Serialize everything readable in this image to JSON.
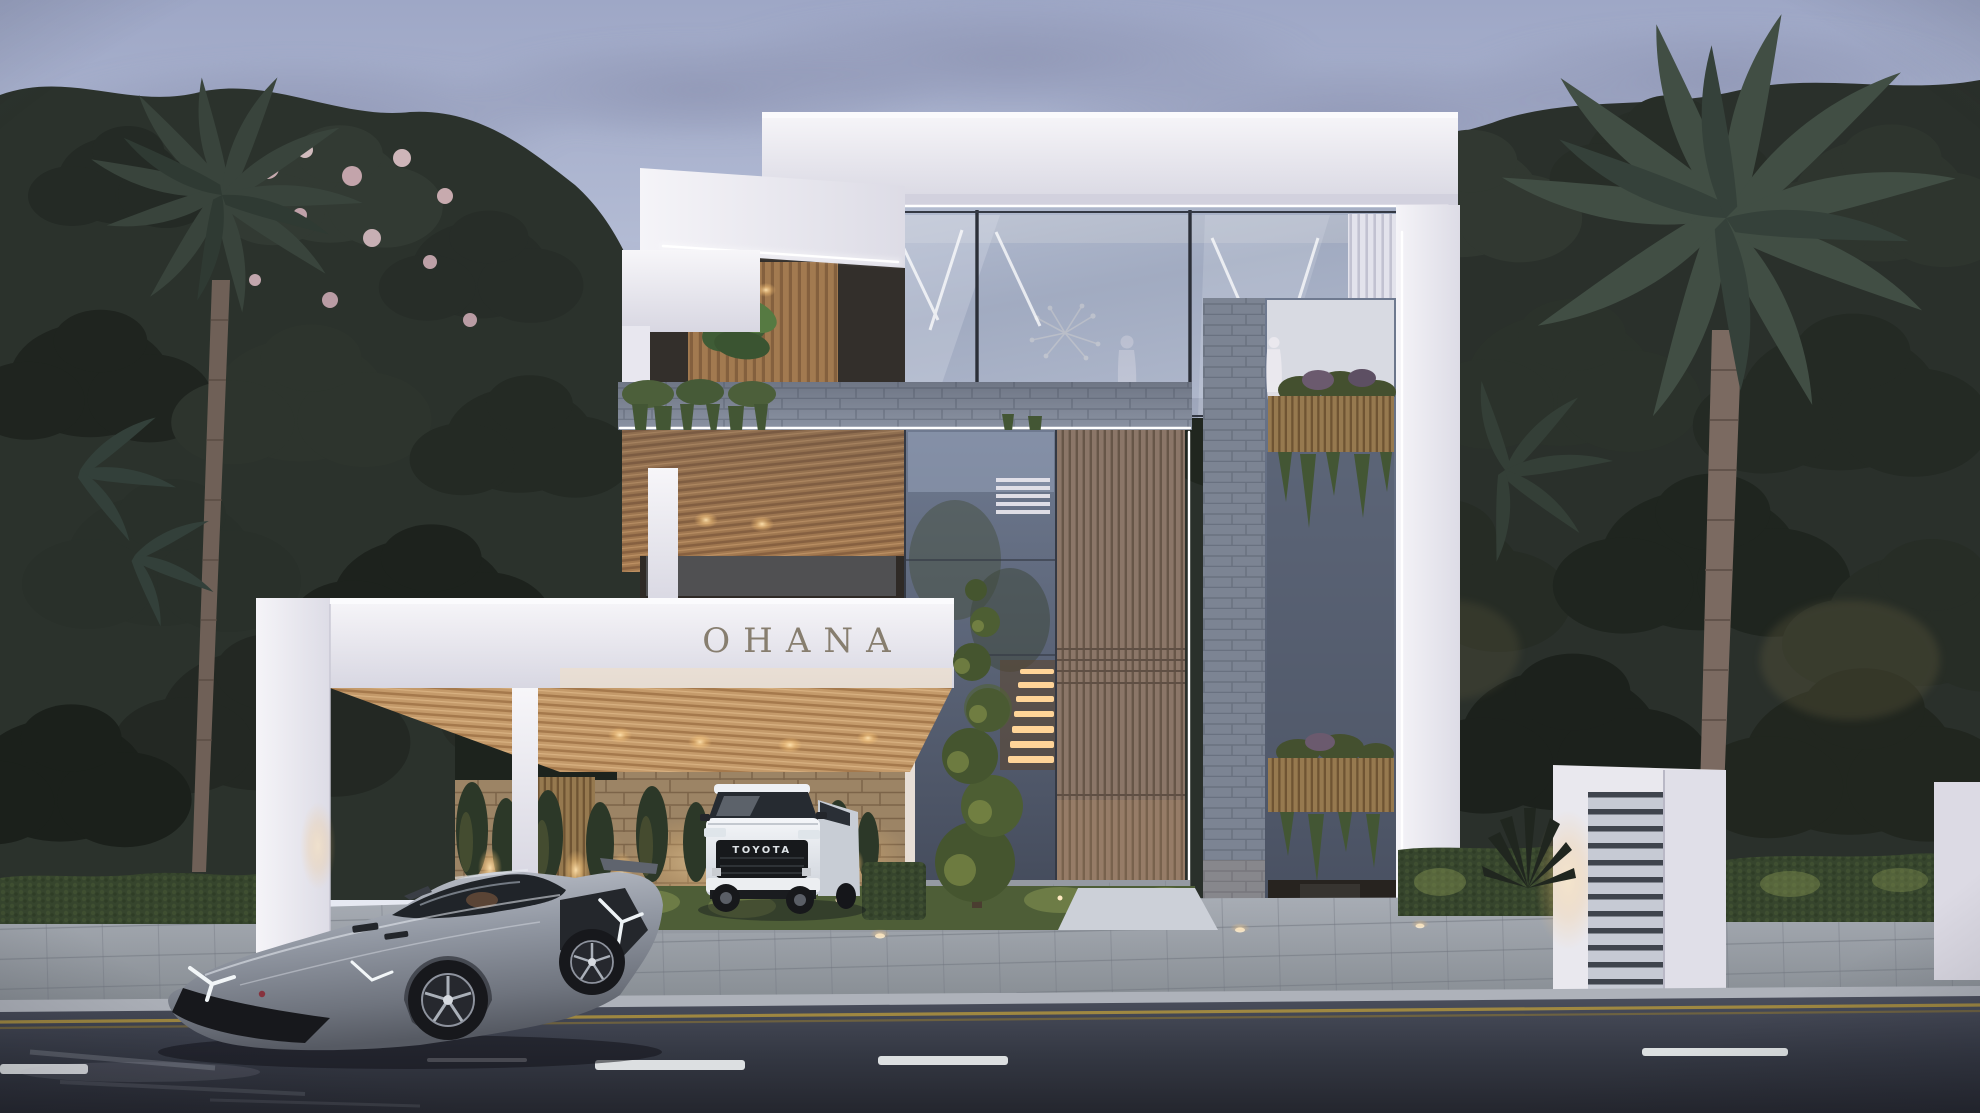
{
  "scene": {
    "type": "exterior-architectural-render",
    "time_of_day": "dusk",
    "signage": {
      "building_name": "OHANA"
    },
    "vehicles": {
      "suv": {
        "badge": "TOYOTA",
        "body_color": "#f2f4f7"
      },
      "supercar": {
        "body_color": "#9298a3"
      }
    },
    "palette": {
      "sky_top": "#9ea7c6",
      "sky_horizon": "#e9ebf3",
      "cloud": "#8e95b2",
      "wall_white": "#f2f1f6",
      "glass_blue": "#8e99b3",
      "wood_warm": "#a57a50",
      "wood_slat": "#8b7668",
      "stone_gray": "#8b93a3",
      "stone_warm": "#9c8465",
      "foliage_dark": "#2a302b",
      "hedge_green": "#36452d",
      "uplight_warm": "#ffd9a0",
      "led_white": "#ffffff",
      "road_asphalt": "#343843",
      "paver_gray": "#9aa0a9",
      "lane_yellow": "#a98f3f",
      "lane_white": "#e6e9ea"
    }
  }
}
